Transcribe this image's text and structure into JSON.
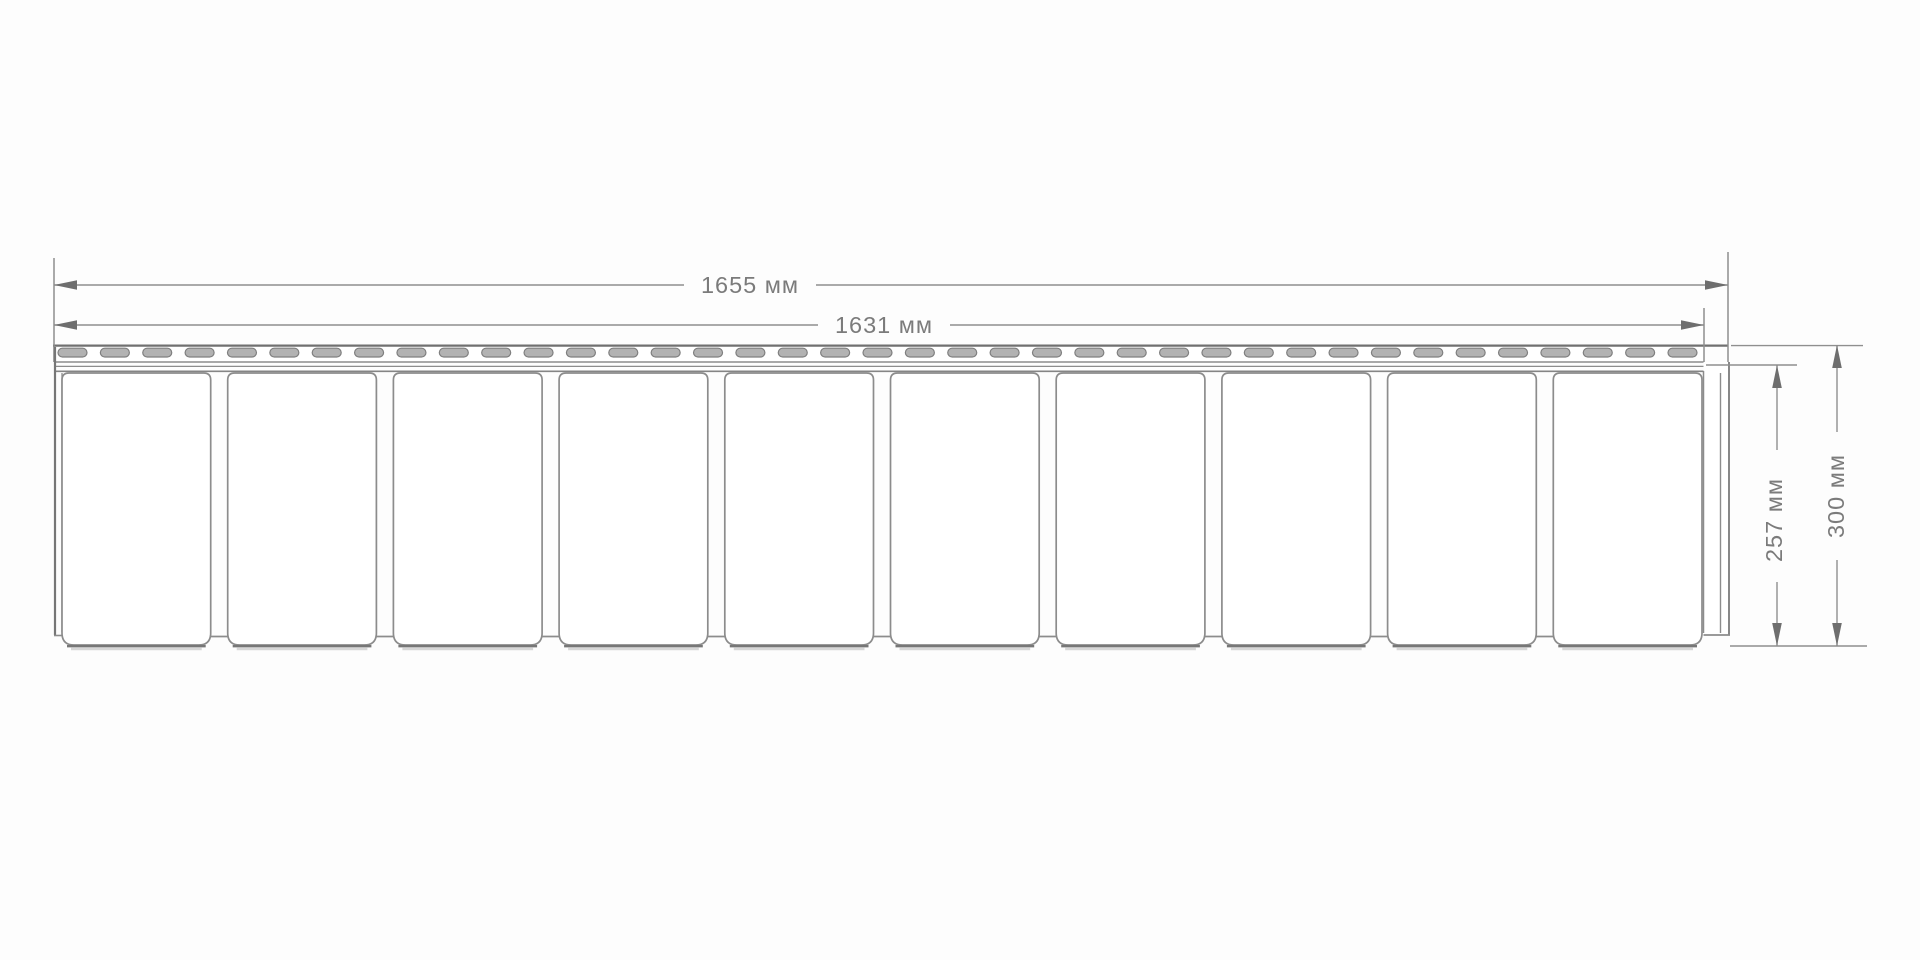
{
  "diagram": {
    "type": "technical-drawing",
    "subject": "siding-panel-profile",
    "labels": {
      "total_width": "1655 мм",
      "hem_width": "1631 мм",
      "face_height": "257 мм",
      "total_height": "300 мм"
    },
    "segment_count": 10,
    "slot_count": 39,
    "colors": {
      "background": "#fdfdfd",
      "outline": "#8c8c8c",
      "outline_dark": "#707070",
      "dim_line": "#8f8f8f",
      "arrow": "#6e6e6e",
      "text": "#7b7b7b",
      "slot_fill": "#b2b2b2",
      "slot_stroke": "#7f7f7f",
      "panel_fill": "#ffffff",
      "bottom_edge": "#777777",
      "shadow": "rgba(130,130,130,0.30)"
    },
    "geometry": {
      "panel_left": 54,
      "hem_right": 1704,
      "panel_right": 1728,
      "hem_top": 345,
      "segment_top": 373,
      "segment_bottom": 645,
      "joint_bottom": 636.5,
      "dim1_y": 285,
      "dim2_y": 325,
      "dim_v1_x": 1777,
      "dim_v2_x": 1837,
      "bottom_ext_y": 646
    }
  }
}
